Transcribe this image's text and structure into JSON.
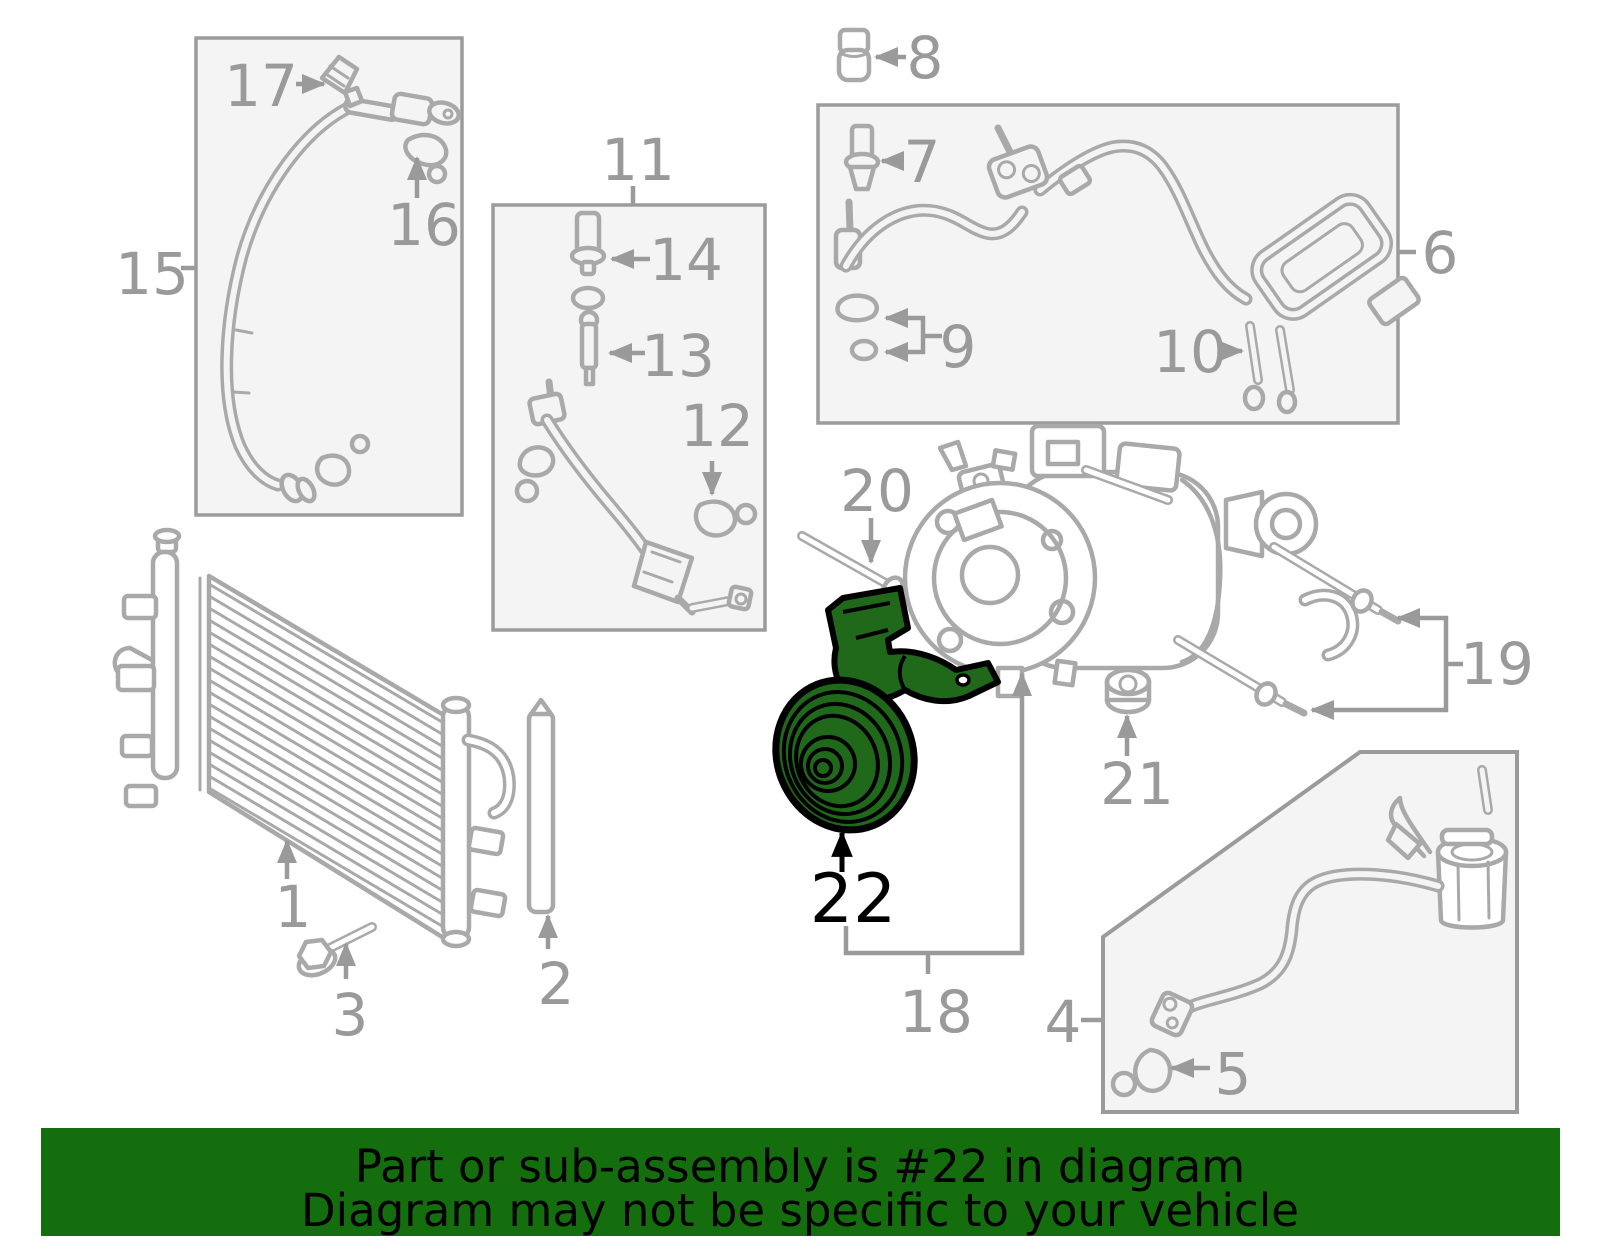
{
  "banner": {
    "line1": "Part or sub-assembly is #22 in diagram",
    "line2": "Diagram may not be specific to your vehicle",
    "bg": "#156e0d",
    "text_color": "#000000"
  },
  "highlight": {
    "part_number": "22",
    "fill": "#20691a",
    "outline": "#000000"
  },
  "colors": {
    "part_outline": "#a9a9a9",
    "label_gray": "#9a9a9a",
    "box_fill": "#f4f4f4",
    "box_border": "#9b9b9b",
    "background": "#ffffff"
  },
  "callouts": {
    "c1": "1",
    "c2": "2",
    "c3": "3",
    "c4": "4",
    "c5": "5",
    "c6": "6",
    "c7": "7",
    "c8": "8",
    "c9": "9",
    "c10": "10",
    "c11": "11",
    "c12": "12",
    "c13": "13",
    "c14": "14",
    "c15": "15",
    "c16": "16",
    "c17": "17",
    "c18": "18",
    "c19": "19",
    "c20": "20",
    "c21": "21",
    "c22": "22"
  }
}
